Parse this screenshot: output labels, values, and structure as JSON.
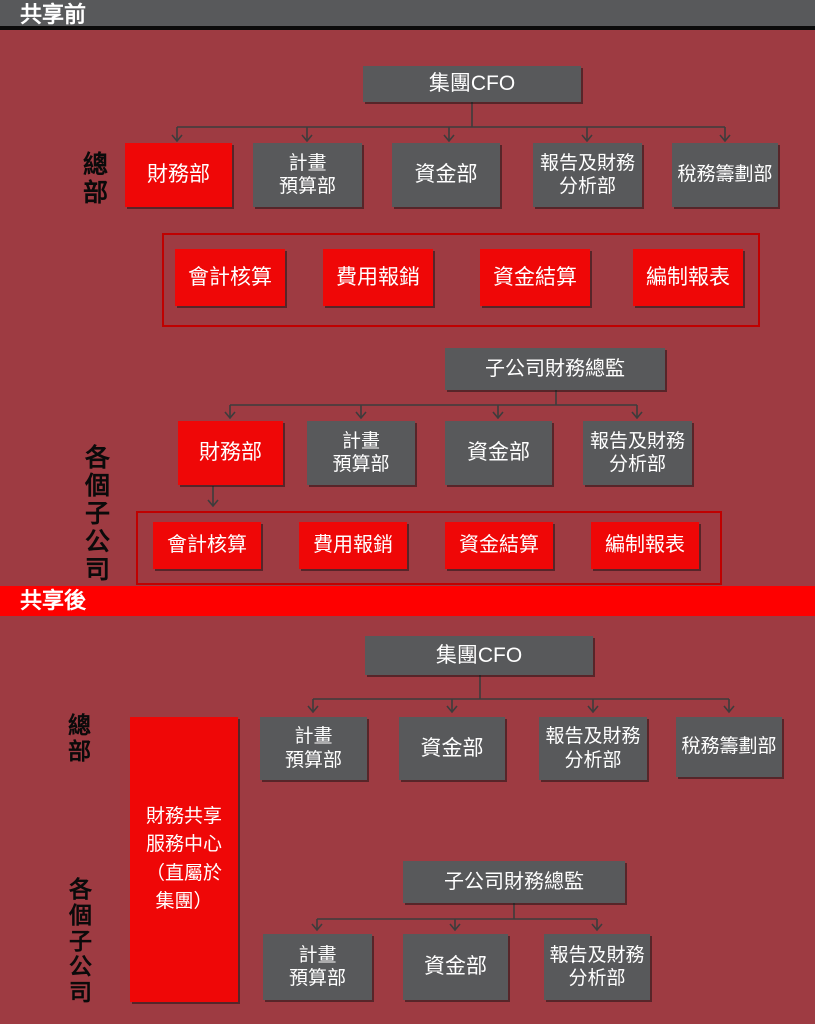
{
  "colors": {
    "background": "#9e3b42",
    "top_bar_gray": "#58595b",
    "node_gray": "#58595b",
    "node_red": "#ef0707",
    "banner_red": "#fe0000",
    "grouping_border_red": "#c00000",
    "connector_gray": "#3c3c3c",
    "side_label_black": "#0a0a0a"
  },
  "sections": {
    "before": {
      "banner": "共享前",
      "hq_label": "總部",
      "subs_label": "各個子公司",
      "group_cfo": "集團CFO",
      "hq_depts": [
        "財務部",
        "計畫\n預算部",
        "資金部",
        "報告及財務\n分析部",
        "稅務籌劃部"
      ],
      "hq_functions": [
        "會計核算",
        "費用報銷",
        "資金結算",
        "編制報表"
      ],
      "sub_head": "子公司財務總監",
      "sub_depts": [
        "財務部",
        "計畫\n預算部",
        "資金部",
        "報告及財務\n分析部"
      ],
      "sub_functions": [
        "會計核算",
        "費用報銷",
        "資金結算",
        "編制報表"
      ]
    },
    "after": {
      "banner": "共享後",
      "hq_label": "總部",
      "subs_label": "各個子公司",
      "group_cfo": "集團CFO",
      "shared_center": "財務共享\n服務中心\n（直屬於\n集團）",
      "hq_depts": [
        "計畫\n預算部",
        "資金部",
        "報告及財務\n分析部",
        "稅務籌劃部"
      ],
      "sub_head": "子公司財務總監",
      "sub_depts": [
        "計畫\n預算部",
        "資金部",
        "報告及財務\n分析部"
      ]
    }
  }
}
